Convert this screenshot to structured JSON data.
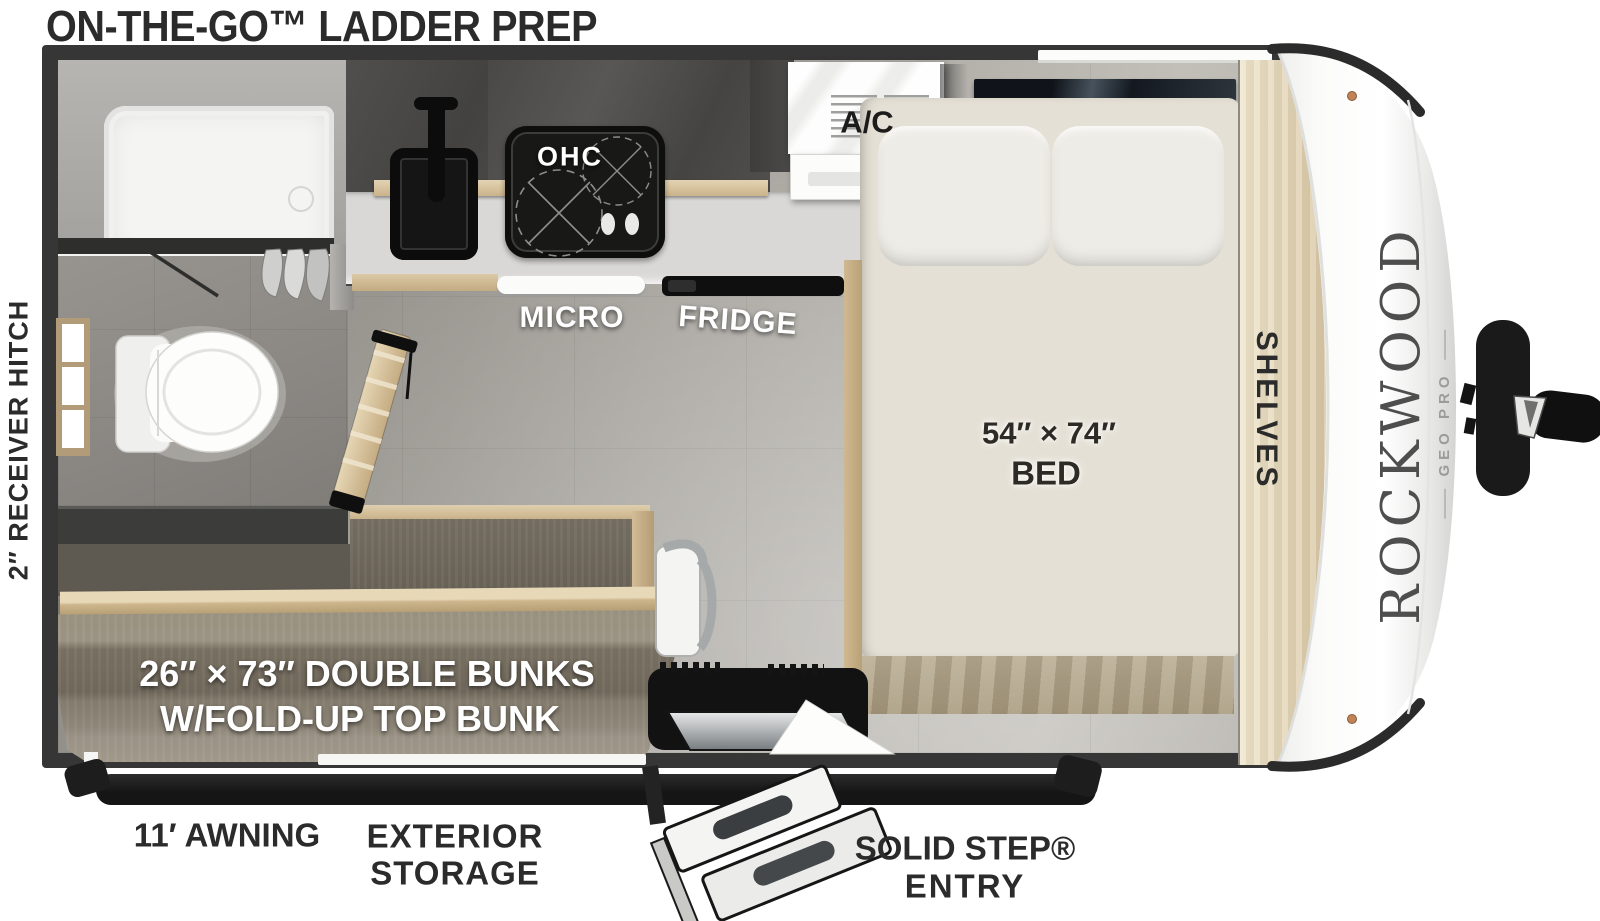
{
  "title": "ON-THE-GO™ LADDER PREP",
  "exterior_labels": {
    "hitch": "2″ RECEIVER HITCH",
    "awning": "11′ AWNING",
    "storage_line1": "EXTERIOR",
    "storage_line2": "STORAGE",
    "entry_line1": "SOLID STEP®",
    "entry_line2": "ENTRY"
  },
  "fixture_labels": {
    "ohc": "OHC",
    "micro": "MICRO",
    "fridge": "FRIDGE",
    "ac": "A/C",
    "bed_size": "54″ × 74″",
    "bed": "BED",
    "shelves": "SHELVES",
    "bunks_line1": "26″ × 73″ DOUBLE BUNKS",
    "bunks_line2": "W/FOLD-UP TOP BUNK"
  },
  "brand": {
    "name": "ROCKWOOD",
    "sub": "GEO PRO"
  },
  "colors": {
    "wall": "#363636",
    "floor_base": "#a8a5a0",
    "bathroom_floor": "#8f8c88",
    "counter": "#d9d8d6",
    "cabinet_dark": "#4e4d4b",
    "wood": "#d5c09b",
    "wood_deep": "#c0a87f",
    "shelves_wood": "#e8dcc0",
    "carpet": "#8b8275",
    "carpet_dark": "#6e675c",
    "mattress": "#e5e0d5",
    "pillow": "#eeece6",
    "appliance_black": "#161616",
    "label_dark": "#2b2b2b",
    "cap_white": "#fbfbfb",
    "brand_gray": "#4e4e4e"
  }
}
